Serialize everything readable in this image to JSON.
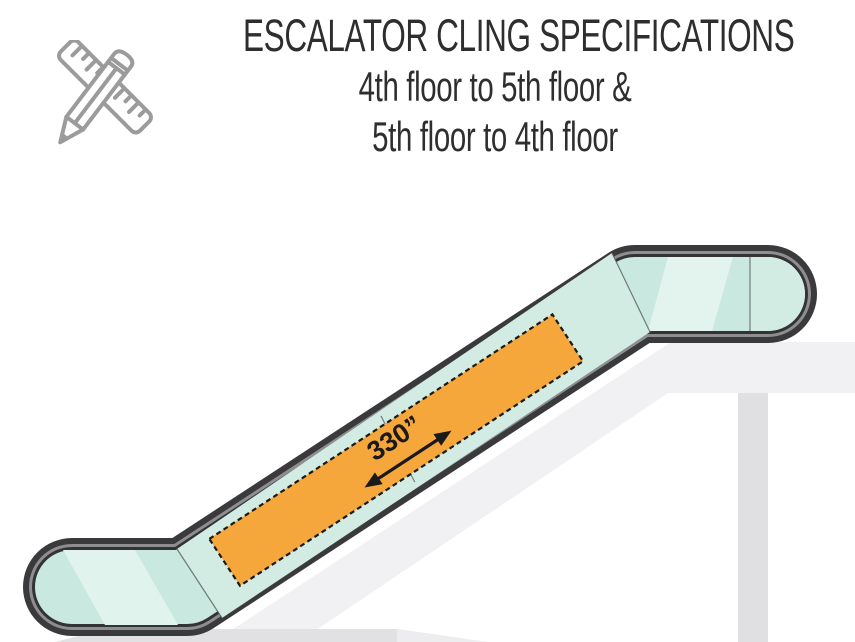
{
  "title": {
    "line1": "ESCALATOR CLING SPECIFICATIONS",
    "line2": "4th floor to 5th floor &",
    "line3": "5th floor to 4th floor"
  },
  "cling": {
    "length_label": "330”"
  },
  "icons": {
    "header": "ruler-and-pencil-icon"
  },
  "colors": {
    "cling_orange": "#F6A73C",
    "cling_border": "#1A1A1A",
    "glass_teal": "#C9E8DF",
    "glass_teal_incline": "#D2ECE4",
    "glass_highlight": "#E0F3ED",
    "glass_cap": "#D3ECE3",
    "handrail_dark": "#3A3A3C",
    "handrail_highlight": "#8E8E90",
    "structure_slab": "#F1F1F3",
    "floor_band": "#E1E1E3",
    "column": "#E0E0E2",
    "icon_gray": "#9B9B9B",
    "title_text": "#2E2E2E"
  }
}
